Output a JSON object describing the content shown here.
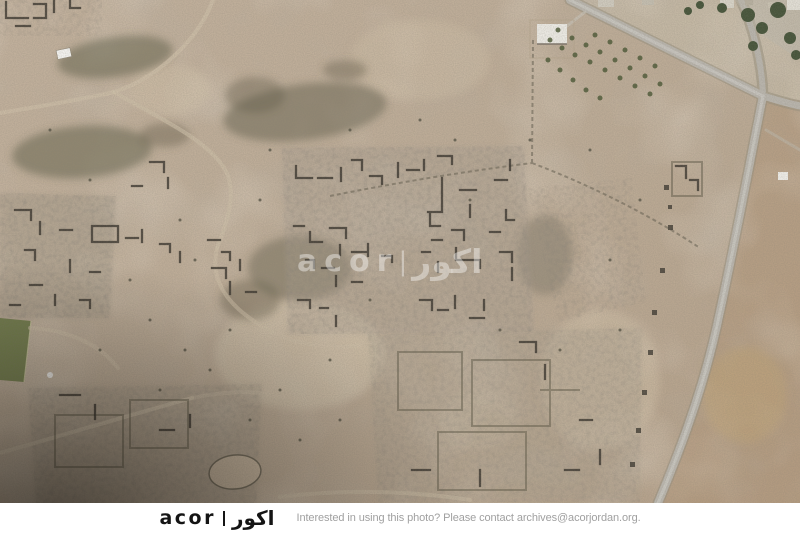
{
  "scene": {
    "type": "aerial-photograph",
    "description": "Oblique aerial view of an archaeological site: excavated dark stone ruins scattered over tan desert ground, a paved road curving along the right side with a junction at top right, a white farm compound with a tree orchard at top right, a green sports pitch at the left edge, dirt tracks crossing the terrain, and a dark vignette in the lower-left corner.",
    "watermark": {
      "latin": "acor",
      "separator": "|",
      "arabic": "اكور"
    }
  },
  "footer": {
    "logo": {
      "latin": "acor",
      "separator": "|",
      "arabic": "اكور"
    },
    "message": "Interested in using this photo? Please contact archives@acorjordan.org."
  },
  "colors": {
    "ground": "#bfae9a",
    "road": "#b9b5ad",
    "field_green": "#76814f",
    "ruin_wall": "#3a362e",
    "footer_background": "#ffffff",
    "logo_black": "#141414",
    "footer_text_gray": "#a0a0a0",
    "watermark_white": "rgba(255,255,255,0.40)"
  }
}
